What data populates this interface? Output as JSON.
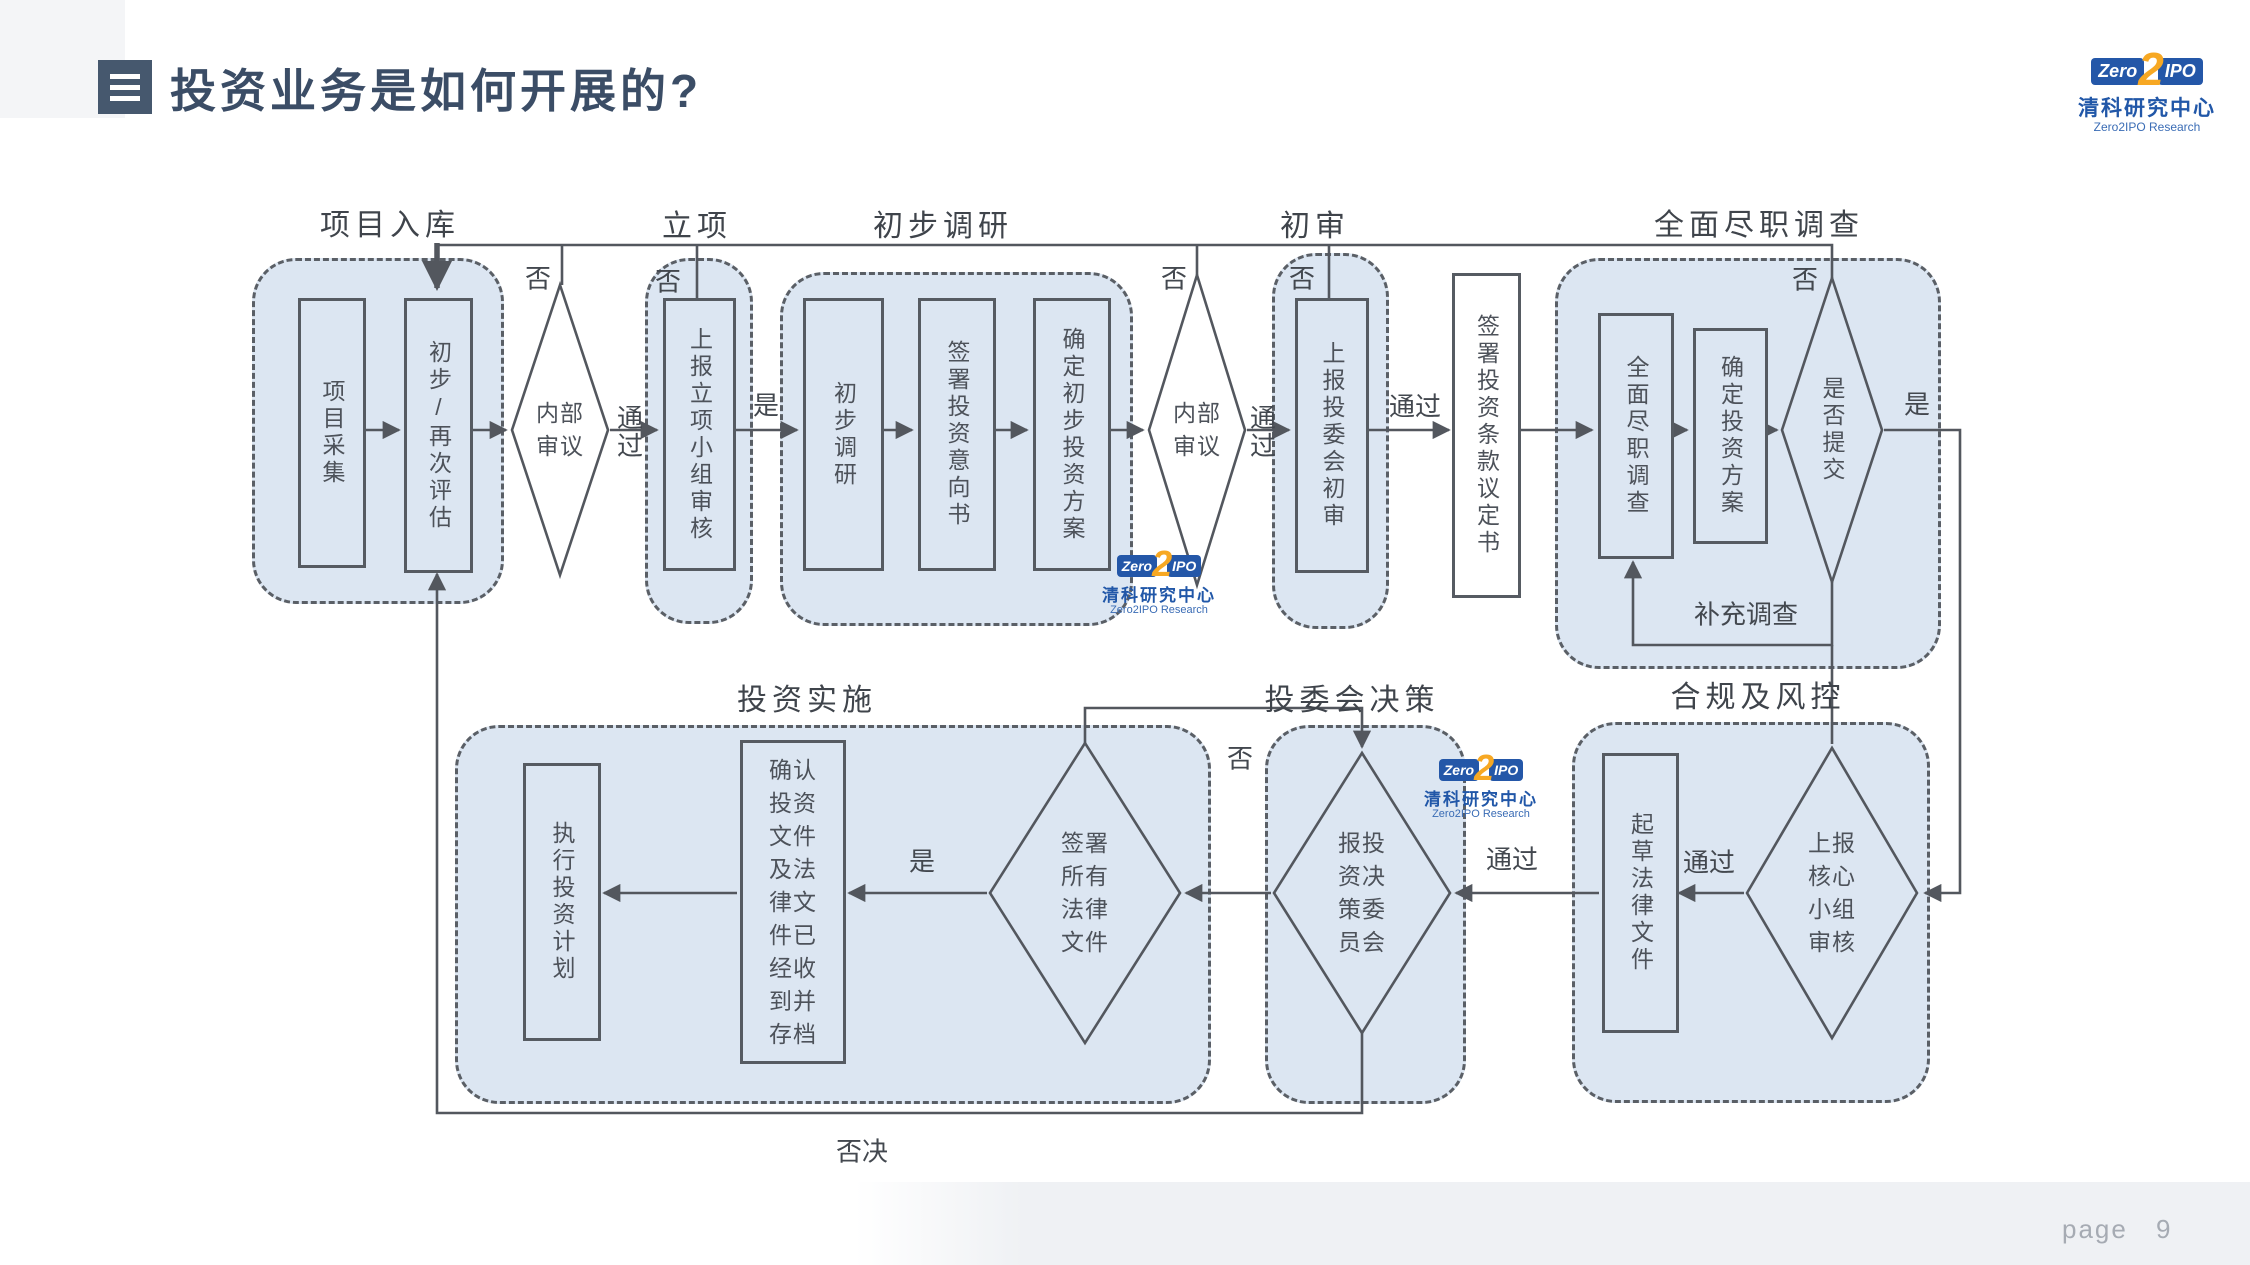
{
  "title": {
    "text": "投资业务是如何开展的?"
  },
  "brand": {
    "zero": "Zero",
    "two": "2",
    "ipo": "IPO",
    "name_cn": "清科研究中心",
    "name_en": "Zero2IPO Research"
  },
  "footer": {
    "page_label": "page",
    "page_number": "9"
  },
  "colors": {
    "section_fill": "#dce6f2",
    "line": "#53575e",
    "title_text": "#3b4d66",
    "logo_blue": "#2457a8",
    "logo_orange": "#f7a823"
  },
  "sections": {
    "project_intake": "项目入库",
    "project_approval": "立项",
    "preliminary_research": "初步调研",
    "initial_review": "初审",
    "due_diligence": "全面尽职调查",
    "investment_execution": "投资实施",
    "committee_decision": "投委会决策",
    "compliance_risk": "合规及风控"
  },
  "nodes": {
    "project_collection": "项目采集",
    "initial_reassessment": "初步/再次评估",
    "internal_review_1": "内部审议",
    "report_project_team": "上报立项小组审核",
    "preliminary_research_step": "初步调研",
    "sign_loi": "签署投资意向书",
    "preliminary_plan": "确定初步投资方案",
    "internal_review_2": "内部审议",
    "ic_initial_review": "上报投委会初审",
    "sign_term_sheet": "签署投资条款议定书",
    "full_due_diligence": "全面尽职调查",
    "investment_plan": "确定投资方案",
    "submit_or_not": "是否提交",
    "execute_plan": "执行投资计划",
    "confirm_archive": "确认投资文件及法律文件已经收到并存档",
    "sign_all_legal": "签署所有法律文件",
    "decision_committee": "报投资决策委员会",
    "draft_legal": "起草法律文件",
    "core_team_review": "上报核心小组审核"
  },
  "edge_labels": {
    "no": "否",
    "yes": "是",
    "pass": "通过",
    "veto": "否决",
    "supplementary": "补充调查"
  }
}
